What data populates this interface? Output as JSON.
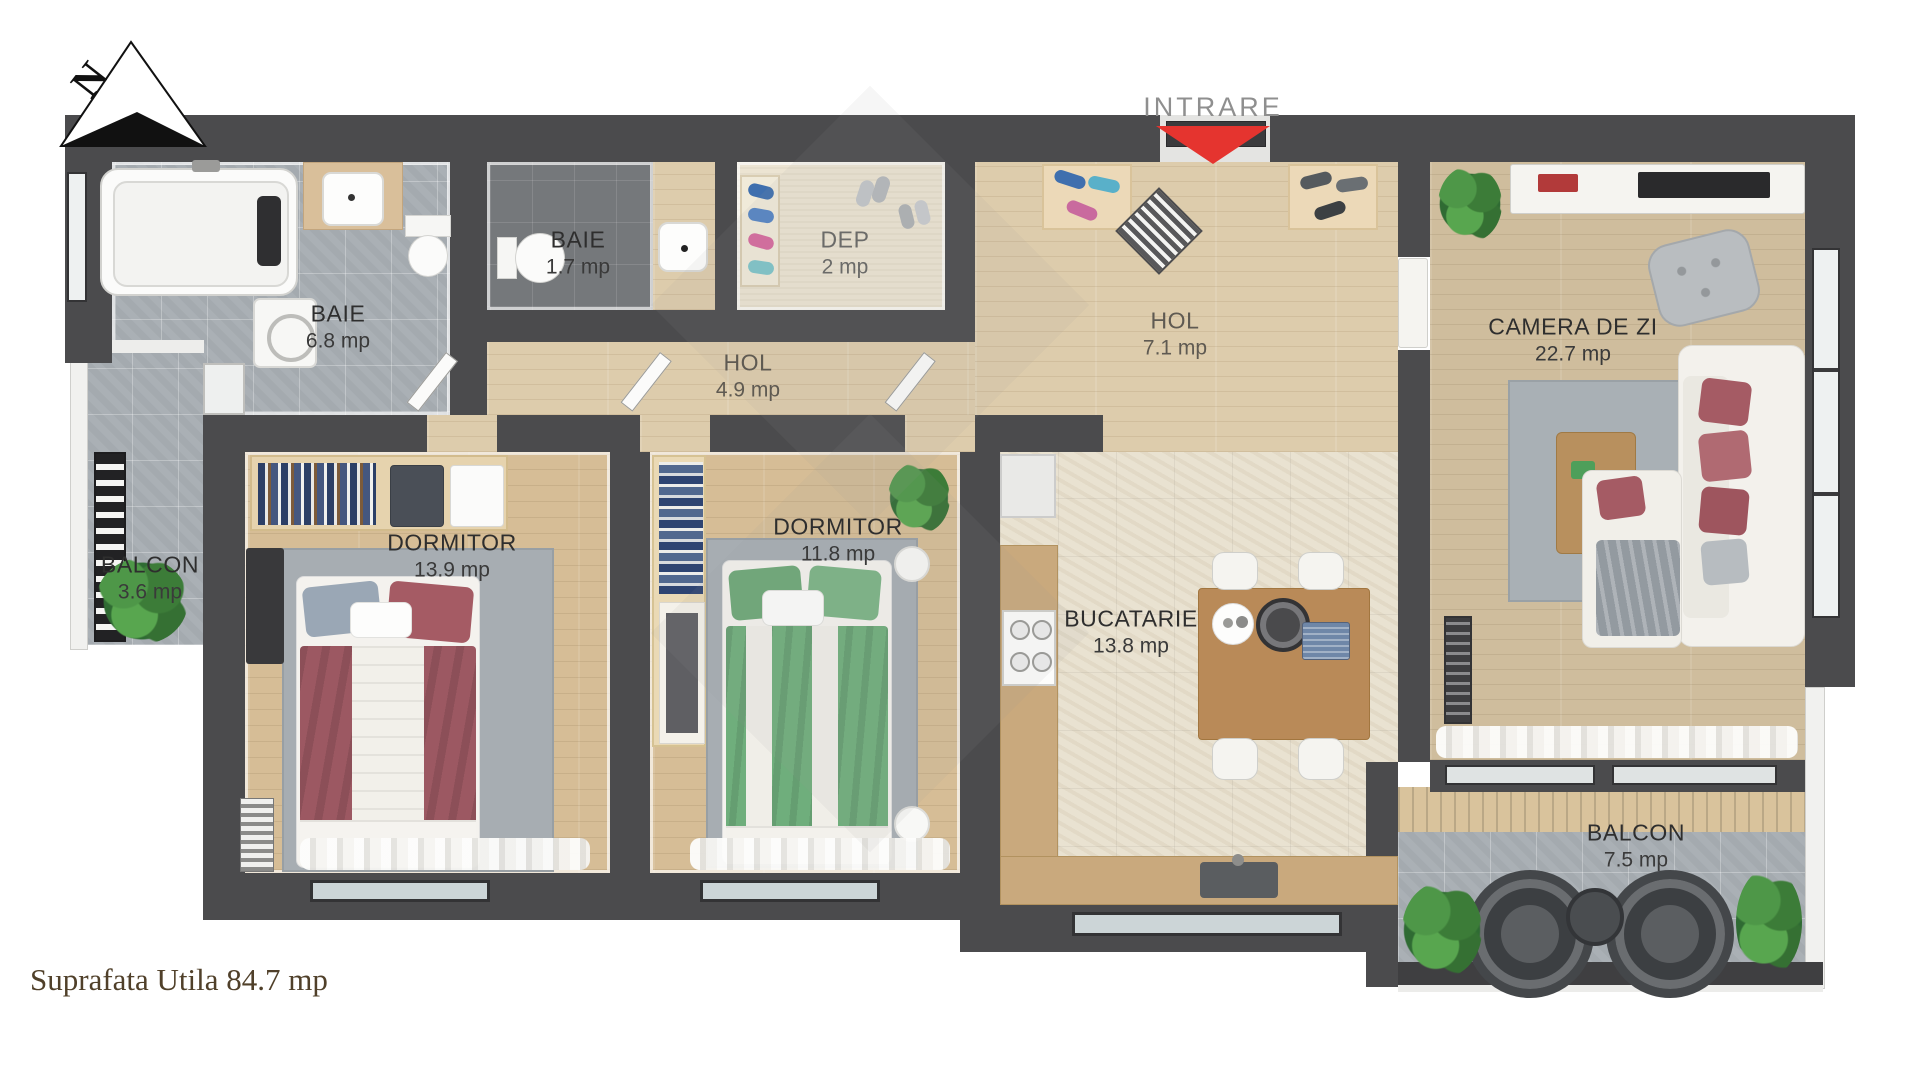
{
  "compass": {
    "label": "N"
  },
  "entrance": {
    "label": "INTRARE"
  },
  "rooms": [
    {
      "id": "baie-mare",
      "name": "BAIE",
      "area": "6.8 mp"
    },
    {
      "id": "baie-mica",
      "name": "BAIE",
      "area": "1.7 mp"
    },
    {
      "id": "dep",
      "name": "DEP",
      "area": "2 mp"
    },
    {
      "id": "hol-mic",
      "name": "HOL",
      "area": "4.9 mp"
    },
    {
      "id": "hol-mare",
      "name": "HOL",
      "area": "7.1 mp"
    },
    {
      "id": "camera-de-zi",
      "name": "CAMERA DE ZI",
      "area": "22.7 mp"
    },
    {
      "id": "dormitor-mare",
      "name": "DORMITOR",
      "area": "13.9 mp"
    },
    {
      "id": "dormitor-mic",
      "name": "DORMITOR",
      "area": "11.8 mp"
    },
    {
      "id": "bucatarie",
      "name": "BUCATARIE",
      "area": "13.8 mp"
    },
    {
      "id": "balcon-mic",
      "name": "BALCON",
      "area": "3.6 mp"
    },
    {
      "id": "balcon-mare",
      "name": "BALCON",
      "area": "7.5 mp"
    }
  ],
  "footer": {
    "total_area_label": "Suprafata Utila 84.7 mp"
  },
  "colors": {
    "entrance_arrow": "#e5342f",
    "wall": "#4b4b4d",
    "label_text": "#2e2e2e",
    "tile_gray": "#aab0b5",
    "wood": "#d6bd96",
    "bed_red": "#9c5862",
    "bed_green": "#6fae7c"
  }
}
